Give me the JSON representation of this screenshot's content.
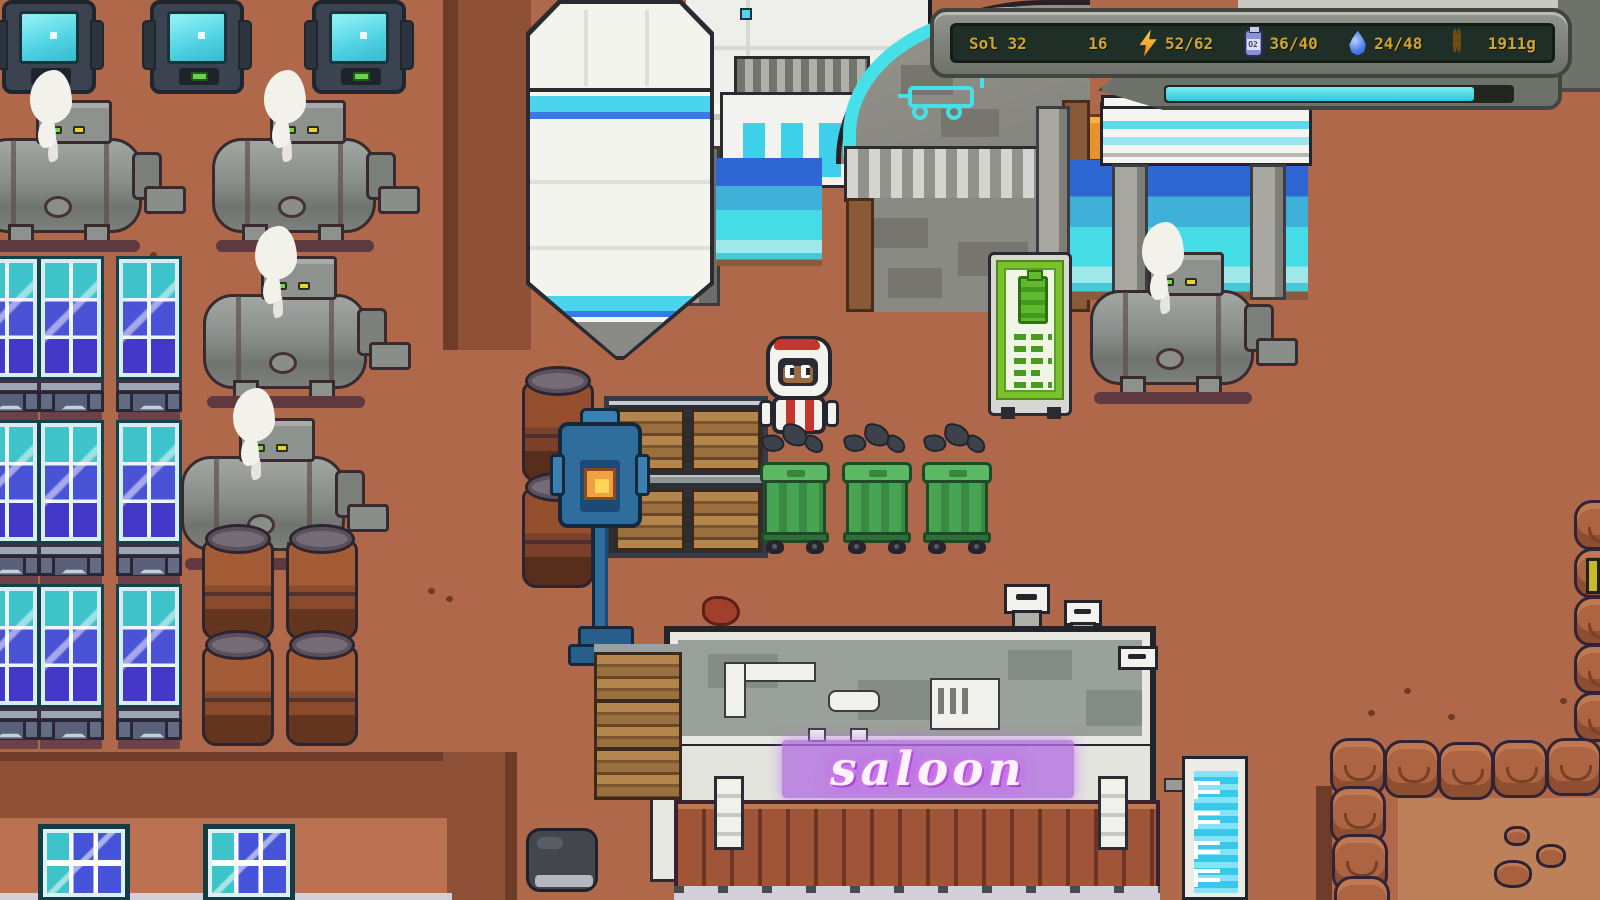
{
  "hud": {
    "sol": "Sol 32",
    "resources": [
      {
        "id": "colonists",
        "icon": "colonist-icon",
        "value": "16"
      },
      {
        "id": "energy",
        "icon": "lightning-bolt-icon",
        "value": "52/62"
      },
      {
        "id": "oxygen",
        "icon": "oxygen-canister-icon",
        "value": "36/40"
      },
      {
        "id": "water",
        "icon": "water-drop-icon",
        "value": "24/48"
      },
      {
        "id": "money",
        "icon": "coins-icon",
        "value": "1911g"
      }
    ],
    "oxygen_label": "O2",
    "progress_percent": 88
  },
  "signs": {
    "saloon": "saloon"
  },
  "colors": {
    "accent_cyan": "#3fe0e8",
    "hud_gold": "#d2a42f",
    "hud_screen_bg": "#1f2e26",
    "neon_purple": "#c04ae8",
    "terrain": "#b0684a",
    "bin_green": "#3f9e4f",
    "water_blue": "#3fb0d8"
  }
}
